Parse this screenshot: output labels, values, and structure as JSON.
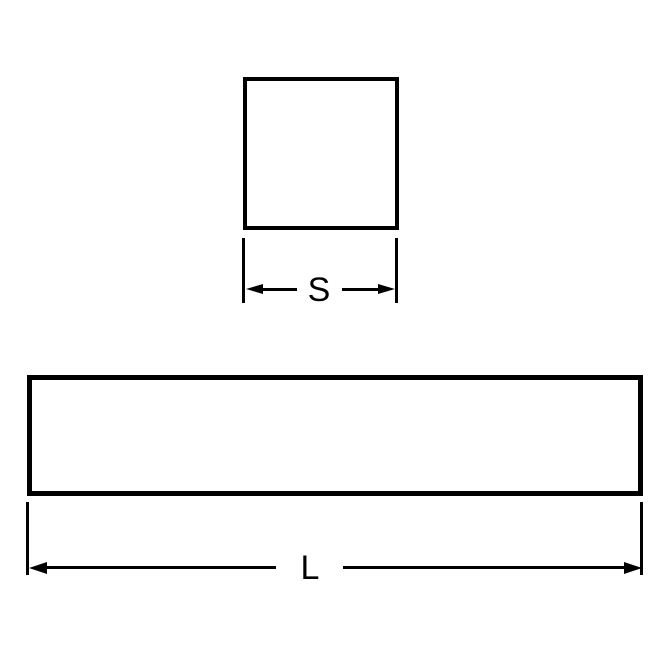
{
  "colors": {
    "line": "#000000",
    "background": "#ffffff"
  },
  "labels": {
    "side": "S",
    "length": "L"
  }
}
